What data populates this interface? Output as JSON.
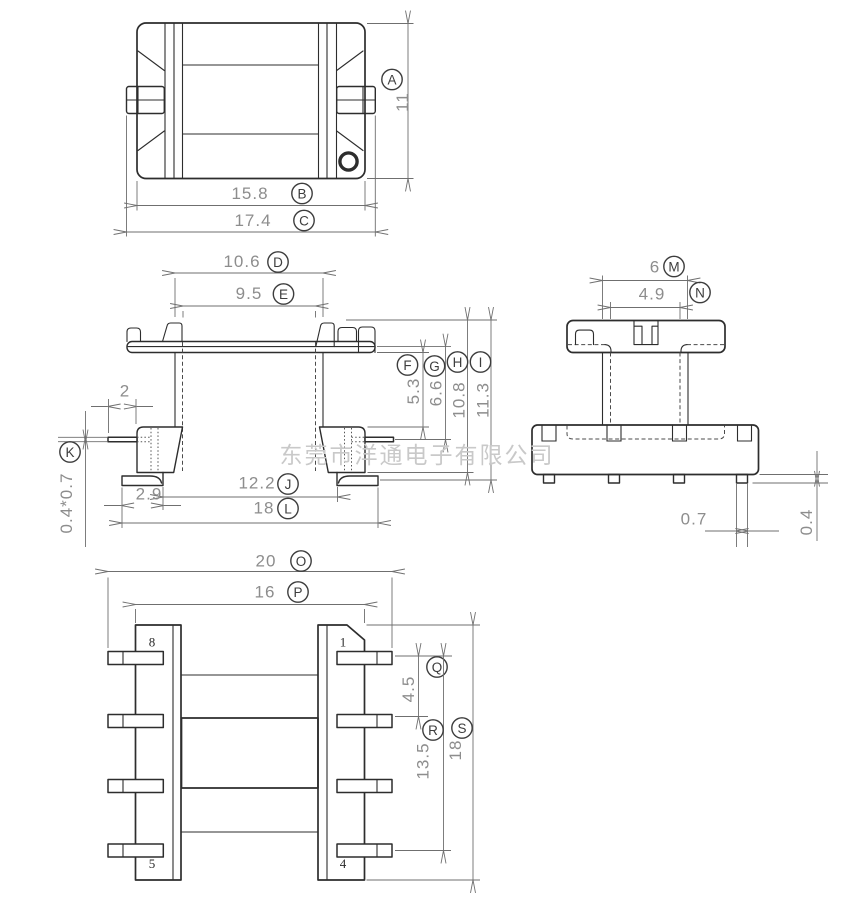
{
  "watermark": "东莞市洋通电子有限公司",
  "dims": {
    "A": {
      "letter": "A",
      "value": "11"
    },
    "B": {
      "letter": "B",
      "value": "15.8"
    },
    "C": {
      "letter": "C",
      "value": "17.4"
    },
    "D": {
      "letter": "D",
      "value": "10.6"
    },
    "E": {
      "letter": "E",
      "value": "9.5"
    },
    "F": {
      "letter": "F",
      "value": "5.3"
    },
    "G": {
      "letter": "G",
      "value": "6.6"
    },
    "H": {
      "letter": "H",
      "value": "10.8"
    },
    "I": {
      "letter": "I",
      "value": "11.3"
    },
    "J": {
      "letter": "J",
      "value": "12.2"
    },
    "K": {
      "letter": "K",
      "value": "0.4*0.7"
    },
    "L": {
      "letter": "L",
      "value": "18"
    },
    "M": {
      "letter": "M",
      "value": "6"
    },
    "N": {
      "letter": "N",
      "value": "4.9"
    },
    "O": {
      "letter": "O",
      "value": "20"
    },
    "P": {
      "letter": "P",
      "value": "16"
    },
    "Q": {
      "letter": "Q",
      "value": "4.5"
    },
    "R": {
      "letter": "R",
      "value": "13.5"
    },
    "S": {
      "letter": "S",
      "value": "18"
    }
  },
  "free_dims": {
    "pin_protrusion": "2",
    "foot_width": "2.9",
    "pin_width": "0.7",
    "standoff_height": "0.4"
  },
  "pin_numbers": {
    "top_left": "8",
    "top_right": "1",
    "bottom_left": "5",
    "bottom_right": "4"
  }
}
